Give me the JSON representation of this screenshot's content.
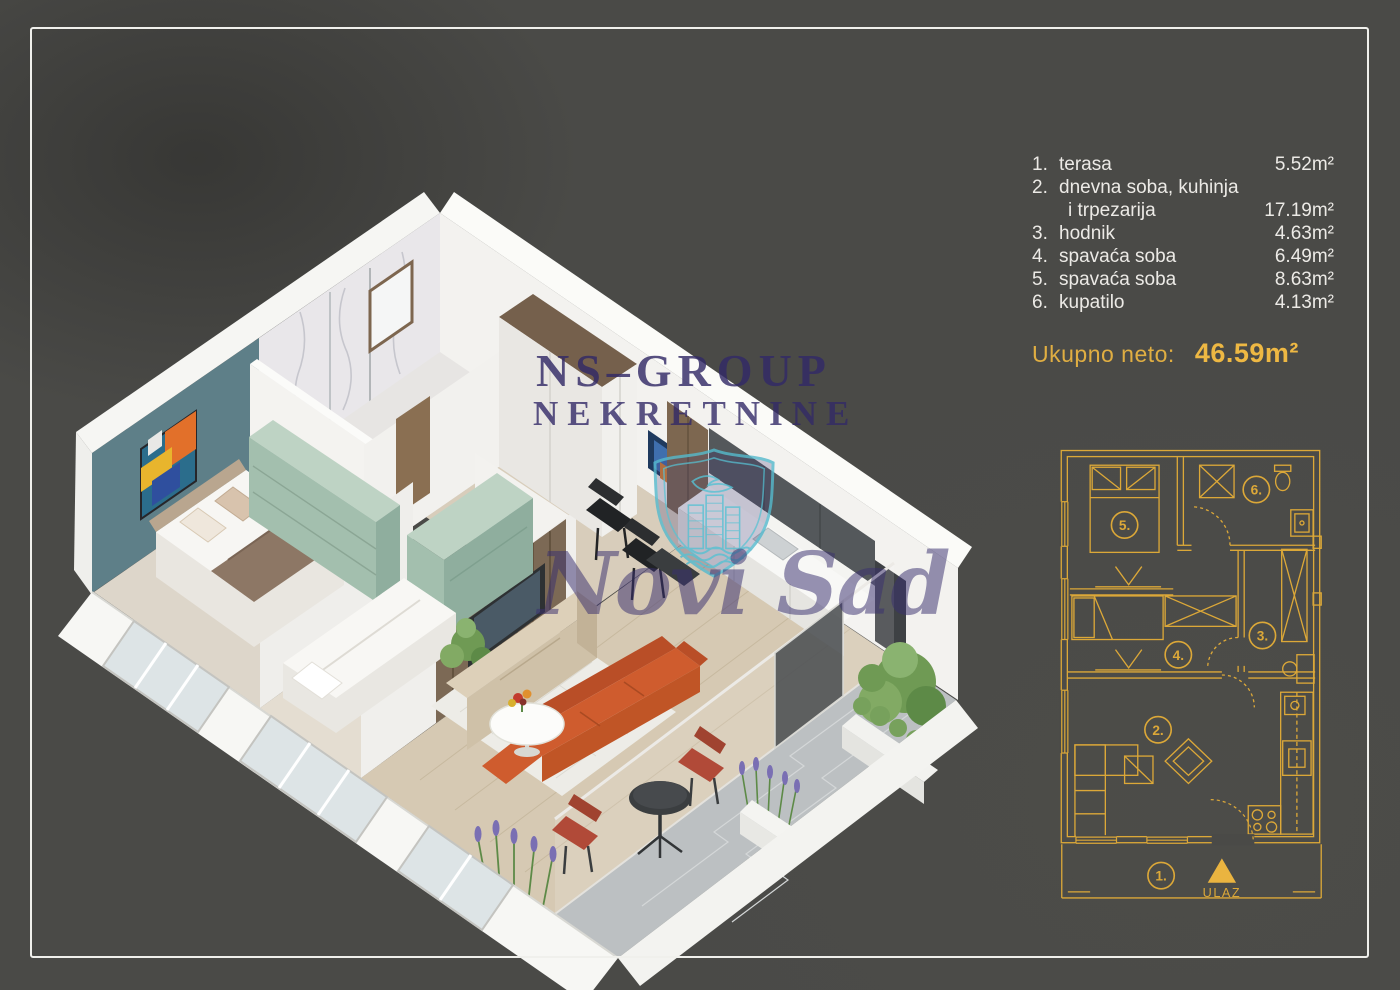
{
  "watermark": {
    "line1": "NS–GROUP",
    "line2": "NEKRETNINE",
    "city_script": "Novi Sad"
  },
  "room_list": {
    "rows": [
      {
        "num": "1.",
        "name": "terasa",
        "area": "5.52m²"
      },
      {
        "num": "2.",
        "name": "dnevna soba, kuhinja",
        "name_line2": "i trpezarija",
        "area": "17.19m²"
      },
      {
        "num": "3.",
        "name": "hodnik",
        "area": "4.63m²"
      },
      {
        "num": "4.",
        "name": "spavaća soba",
        "area": "6.49m²"
      },
      {
        "num": "5.",
        "name": "spavaća soba",
        "area": "8.63m²"
      },
      {
        "num": "6.",
        "name": "kupatilo",
        "area": "4.13m²"
      }
    ],
    "total_label": "Ukupno neto:",
    "total_value": "46.59m²"
  },
  "plan2d": {
    "labels": {
      "room1": "1.",
      "room2": "2.",
      "room3": "3.",
      "room4": "4.",
      "room5": "5.",
      "room6": "6."
    },
    "entrance_label": "ULAZ"
  },
  "colors": {
    "background": "#4a4a47",
    "frame_border": "#f0f0ec",
    "plan_gold": "#dca838",
    "total_gold": "#eeb843",
    "list_text": "#eceae6",
    "watermark_purple": "#322966",
    "logo_teal": "#55b9cd",
    "accent_wall_teal": "#5e7f88",
    "dresser_green": "#a3bfae",
    "sofa_orange": "#cf5c2e"
  }
}
